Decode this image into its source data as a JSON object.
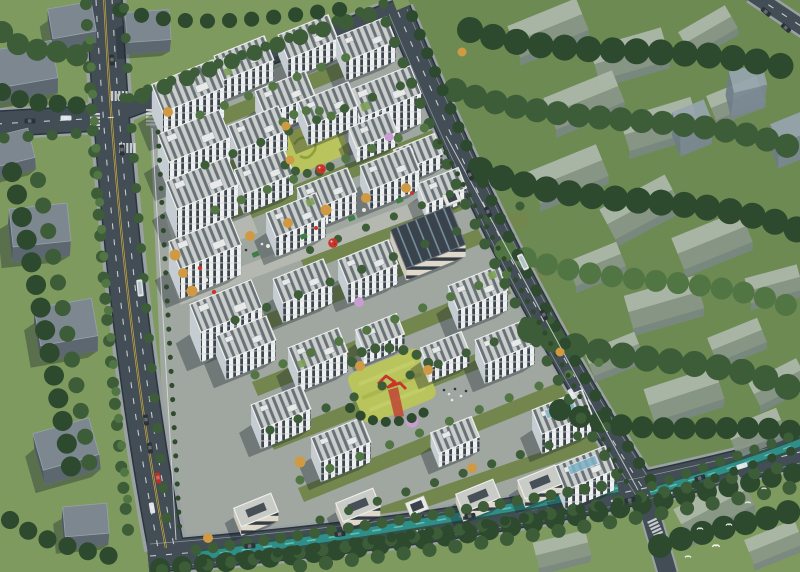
{
  "image": {
    "kind": "aerial architectural rendering",
    "subject": "residential masterplan community seen from a bird's-eye oblique view",
    "visible_text": "",
    "lighting": "daytime, sun from upper right, shadows cast to lower left"
  },
  "palette": {
    "context_lawn": "#7f9a5e",
    "site_grass": "#73864d",
    "lawn_bright": "#b9c45c",
    "forest_dark": "#2d4a2f",
    "forest_mid": "#3d5c38",
    "forest_light": "#527544",
    "asphalt": "#424d56",
    "asphalt_edge": "#2c353d",
    "sidewalk": "#9aa1a3",
    "paving": "#a0a7a1",
    "paving_light": "#b4b8b0",
    "facade": "#edf0ee",
    "facade_shade": "#c6cdd2",
    "window": "#3d464e",
    "roof_base": "#cbcfcb",
    "roof_strip": "#58616a",
    "roof_green": "#7da257",
    "ghost_light": "#aeb9ab",
    "ghost_dark": "#8a9789",
    "ghost_blue_light": "#97a5b0",
    "ghost_blue_dark": "#7a8894",
    "slab_roof": "#7d8790",
    "slab_face": "#5d6770",
    "cream": "#ded9ca",
    "canal_water": "#2f8e88",
    "canal_bank": "#335248",
    "canal_glint": "#6fcabf",
    "accent_red": "#c7352b",
    "autumn": "#cf9a43",
    "pink": "#c79ed2",
    "line_yellow": "#d9b43c",
    "line_white": "#e9ebea",
    "shadow_col": "rgba(24,33,43,0.35)",
    "car_dark": "#2b323a",
    "car_white": "#e0e4e6",
    "blue_glass": "#7fb4c9"
  },
  "scene": {
    "site": {
      "residential_towers": 32,
      "low_rise_street_buildings": 4,
      "community_building_dark_roof": 1,
      "entrance_gates": 2,
      "patterned_lawns": 2,
      "central_park_with_red_sculpture": 1,
      "red_balloon_sculptures": 2,
      "commercial_pedestrian_axis": 1,
      "pink_blossom_trees": 3
    },
    "context": {
      "ghost_gable_buildings": 21,
      "ghost_tall_blocks": 3,
      "solid_grey_buildings": 8,
      "dense_forest": "east and perimeter"
    },
    "infrastructure": {
      "roads": [
        "west arterial",
        "north edge street",
        "east diagonal road",
        "south boulevard"
      ],
      "intersections": 2,
      "canal": "teal stream along the south edge",
      "vehicles": 22,
      "white_birds": 6
    }
  }
}
